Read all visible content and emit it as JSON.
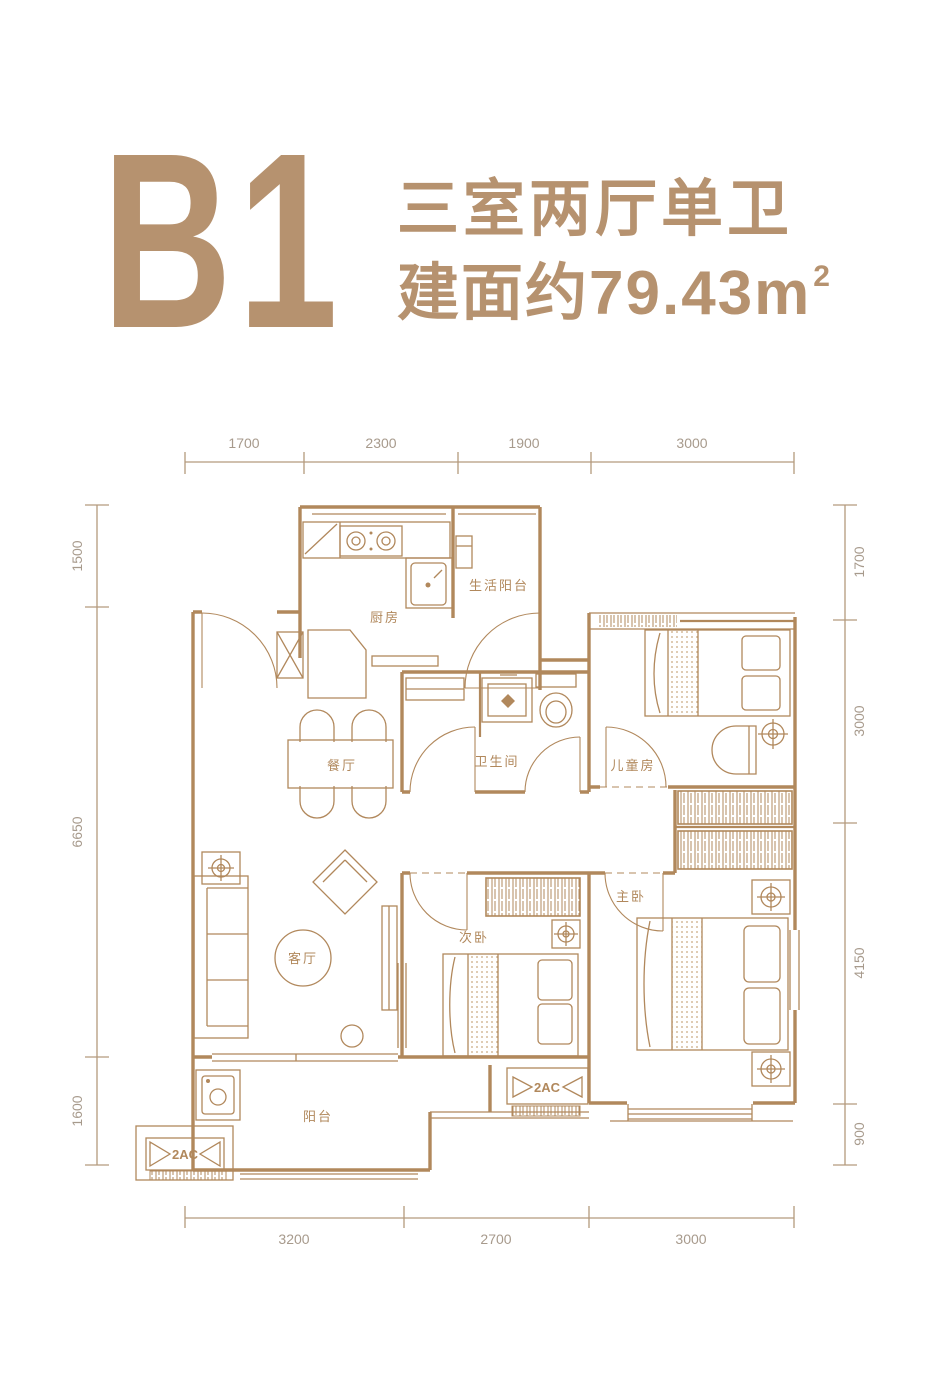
{
  "header": {
    "unit": "B1",
    "layout": "三室两厅单卫",
    "area_text": "建面约79.43m",
    "area_sup": "2"
  },
  "rooms": {
    "kitchen": "厨房",
    "service_balcony": "生活阳台",
    "dining": "餐厅",
    "bathroom": "卫生间",
    "kids": "儿童房",
    "master": "主卧",
    "second": "次卧",
    "living": "客厅",
    "balcony": "阳台"
  },
  "ac": {
    "left": "2AC",
    "middle": "2AC"
  },
  "dimensions": {
    "top": [
      "1700",
      "2300",
      "1900",
      "3000"
    ],
    "bottom": [
      "3200",
      "2700",
      "3000"
    ],
    "left": [
      "1500",
      "6650",
      "1600"
    ],
    "right": [
      "1700",
      "3000",
      "4150",
      "900"
    ]
  },
  "colors": {
    "line": "#b1885c",
    "title": "#b6926f",
    "dim_text": "#a79a8c"
  }
}
